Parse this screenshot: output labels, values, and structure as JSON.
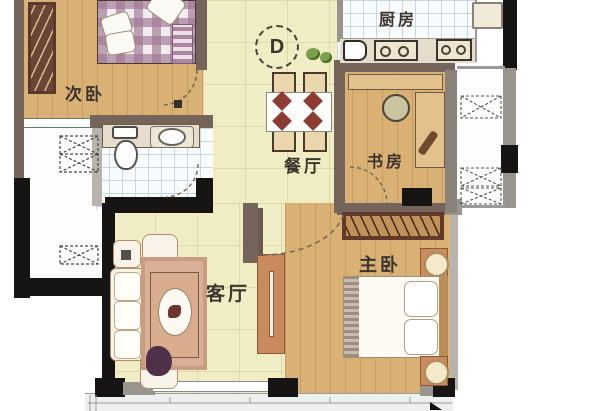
{
  "plan": {
    "title_marker": "D",
    "rooms": {
      "secondary_bedroom": {
        "label": "次卧"
      },
      "kitchen": {
        "label": "厨房"
      },
      "dining": {
        "label": "餐厅"
      },
      "study": {
        "label": "书房"
      },
      "living": {
        "label": "客厅"
      },
      "master_bedroom": {
        "label": "主卧"
      }
    },
    "colors": {
      "wood_floor": "#d9b174",
      "cream_floor": "#f0ecc3",
      "tile_white": "#f8fbfb",
      "tile_grid": "#c8d8dc",
      "wall_brown": "#75645a",
      "wall_black": "#171514",
      "wall_gray": "#9a948e",
      "counter_beige": "#e7ddcc",
      "cabinet_orange": "#c98b5e",
      "label_color": "#3b342e"
    }
  }
}
